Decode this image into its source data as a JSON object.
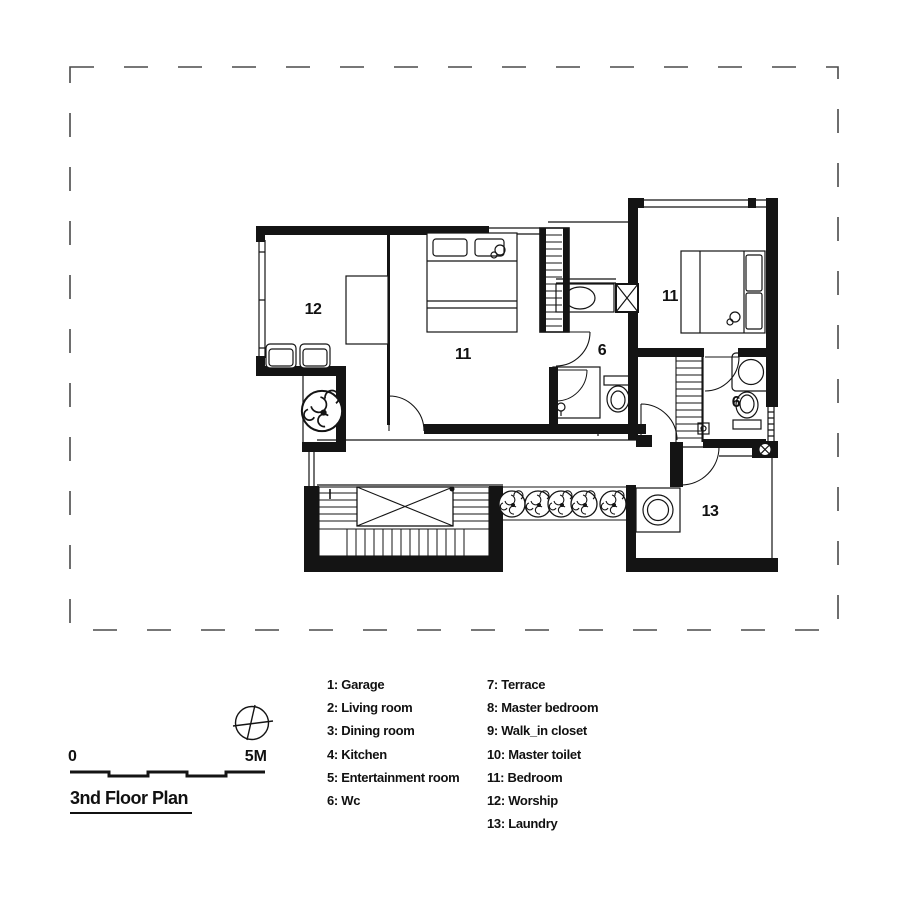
{
  "title": "3nd Floor Plan",
  "scale_bar": {
    "start_label": "0",
    "end_label": "5M"
  },
  "plan": {
    "room_labels": [
      {
        "name": "worship",
        "label": "12"
      },
      {
        "name": "bedroom-left",
        "label": "11"
      },
      {
        "name": "wc-middle",
        "label": "6"
      },
      {
        "name": "bedroom-right",
        "label": "11"
      },
      {
        "name": "wc-right",
        "label": "6"
      },
      {
        "name": "laundry",
        "label": "13"
      }
    ]
  },
  "legend": {
    "column1": [
      "1: Garage",
      "2: Living room",
      "3: Dining room",
      "4: Kitchen",
      "5: Entertainment room",
      "6: Wc"
    ],
    "column2": [
      "7: Terrace",
      "8: Master bedroom",
      "9: Walk_in closet",
      "10: Master toilet",
      "11: Bedroom",
      "12: Worship",
      "13: Laundry"
    ]
  },
  "icons": {
    "north_indicator": "compass-icon",
    "vegetation": "plant-icon",
    "column_marker": "x-column-icon",
    "shaft_marker": "circle-x-shaft-icon"
  },
  "colors": {
    "line": "#141414",
    "boundary_dash": "#4a4a4a",
    "background": "#ffffff"
  }
}
